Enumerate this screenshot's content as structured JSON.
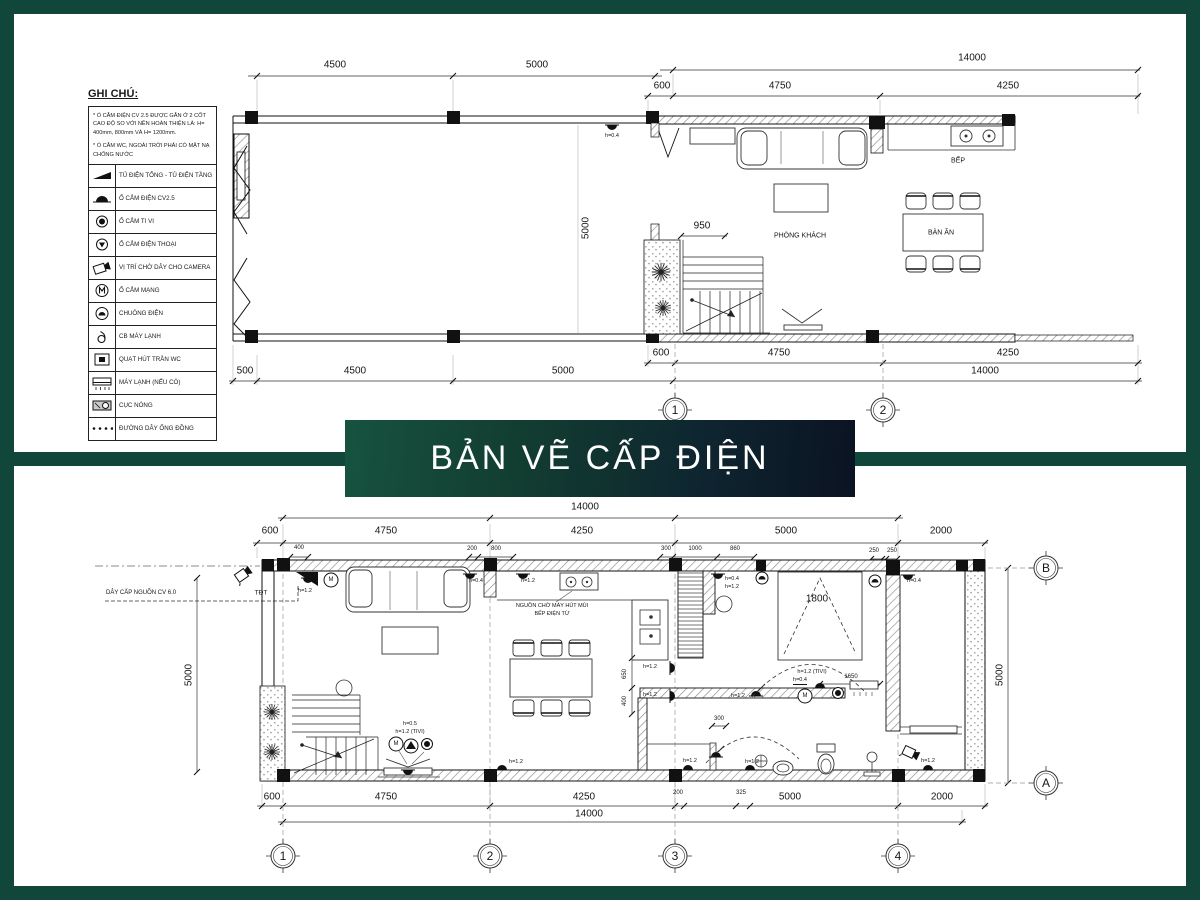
{
  "banner": {
    "title": "BẢN VẼ CẤP ĐIỆN"
  },
  "legend": {
    "title": "GHI CHÚ:",
    "notes": [
      "* Ổ CẮM ĐIỆN CV 2.5 ĐƯỢC GẮN Ở 2 CỐT CAO ĐỘ SO VỚI NỀN HOÀN THIỆN LÀ: H= 400mm, 800mm VÀ H= 1200mm.",
      "* Ổ CẮM WC, NGOÀI TRỜI PHẢI CÓ MẶT NẠ CHỐNG NƯỚC"
    ],
    "items": [
      {
        "icon": "distribution-board-icon",
        "label": "TỦ ĐIỆN TỔNG - TỦ ĐIỆN TẦNG"
      },
      {
        "icon": "power-socket-icon",
        "label": "Ổ CẮM ĐIỆN CV2.5"
      },
      {
        "icon": "tv-socket-icon",
        "label": "Ổ CẮM TI VI"
      },
      {
        "icon": "phone-socket-icon",
        "label": "Ổ CẮM ĐIỆN THOẠI"
      },
      {
        "icon": "camera-icon",
        "label": "VỊ TRÍ CHỜ DÂY CHO CAMERA"
      },
      {
        "icon": "network-socket-icon",
        "label": "Ổ CẮM MẠNG"
      },
      {
        "icon": "doorbell-icon",
        "label": "CHUÔNG ĐIỆN"
      },
      {
        "icon": "ac-breaker-icon",
        "label": "CB MÁY LẠNH"
      },
      {
        "icon": "wc-ceiling-fan-icon",
        "label": "QUẠT HÚT TRẦN WC"
      },
      {
        "icon": "ac-unit-icon",
        "label": "MÁY LẠNH (NẾU CÓ)"
      },
      {
        "icon": "condenser-unit-icon",
        "label": "CỤC NÓNG"
      },
      {
        "icon": "copper-line-icon",
        "label": "ĐƯỜNG DÂY ỐNG ĐỒNG"
      }
    ]
  },
  "plan_top": {
    "grid": {
      "c1": "1",
      "c2": "2"
    },
    "rooms": {
      "living": "PHÒNG KHÁCH",
      "kitchen": "BẾP",
      "dining": "BÀN ĂN"
    },
    "dims": {
      "top_4500": "4500",
      "top_5000": "5000",
      "top_total": "14000",
      "top_600": "600",
      "top_4750": "4750",
      "top_4250": "4250",
      "bot_500": "500",
      "bot_4500": "4500",
      "bot_5000": "5000",
      "bot_600": "600",
      "bot_4750": "4750",
      "bot_4250": "4250",
      "bot_total": "14000",
      "stair_950": "950",
      "vert_5000": "5000"
    },
    "labels": {
      "socket_h": "h=0.4"
    }
  },
  "plan_bottom": {
    "grid": {
      "c1": "1",
      "c2": "2",
      "c3": "3",
      "c4": "4",
      "rA": "A",
      "rB": "B"
    },
    "dims": {
      "top_total": "14000",
      "top_600": "600",
      "top_4750": "4750",
      "top_4250": "4250",
      "top_5000": "5000",
      "top_2000": "2000",
      "sub_400": "400",
      "sub_200": "200",
      "sub_800": "800",
      "sub_300": "300",
      "sub_1000": "1000",
      "sub_860": "860",
      "sub_250a": "250",
      "sub_250b": "250",
      "bot_600": "600",
      "bot_4750": "4750",
      "bot_4250": "4250",
      "bot_200": "200",
      "bot_325": "325",
      "bot_5000": "5000",
      "bot_2000": "2000",
      "bot_total": "14000",
      "left_5000": "5000",
      "right_5000": "5000",
      "bed_1800": "1800",
      "tv_1650": "1650",
      "k_650": "650",
      "k_400": "400",
      "wc_300": "300"
    },
    "labels": {
      "supply": "DÂY CẤP NGUỒN CV 6.0",
      "tdt": "TĐT",
      "hood1": "NGUỒN CHỜ MÁY HÚT MÙI",
      "hood2": "BẾP ĐIỆN TỪ",
      "m": "M",
      "h04": "h=0.4",
      "h05": "h=0.5",
      "h12": "h=1.2",
      "h12tv": "h=1.2 (TIVI)"
    }
  }
}
